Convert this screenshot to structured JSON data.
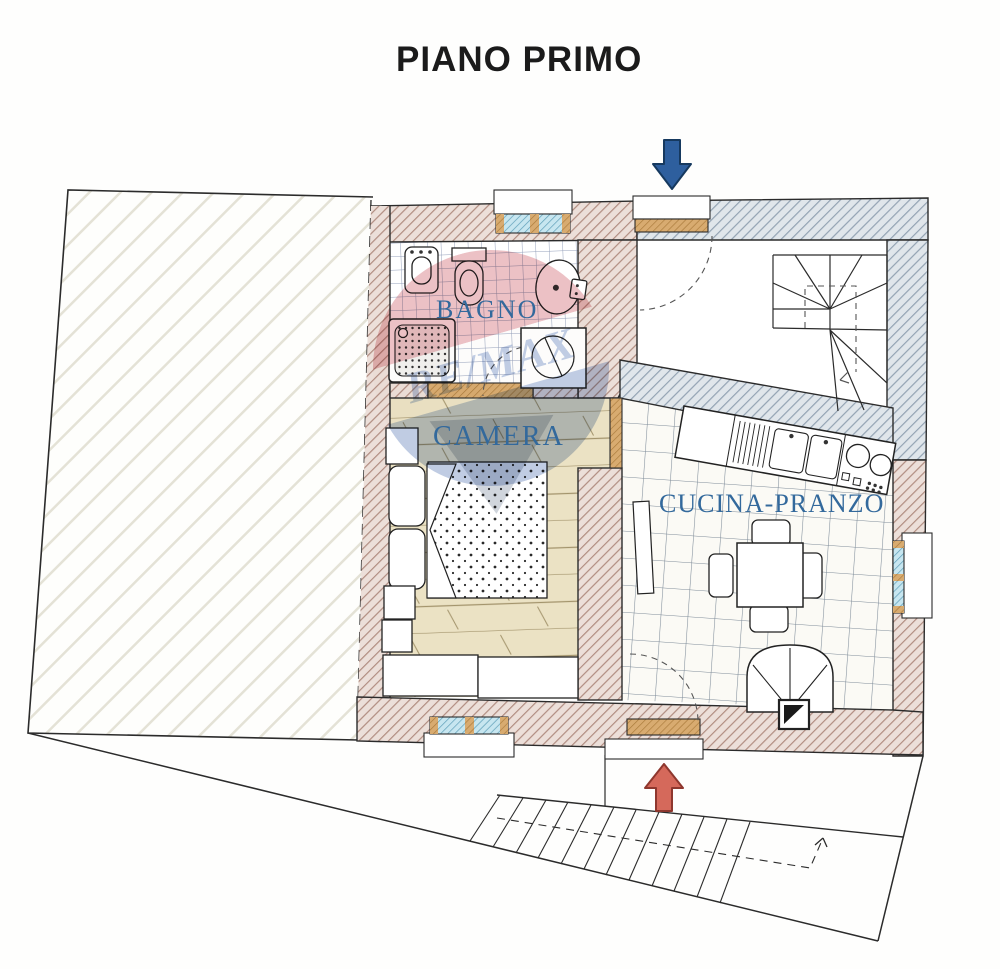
{
  "title": "PIANO PRIMO",
  "rooms": {
    "bathroom": "BAGNO",
    "bedroom": "CAMERA",
    "kitchen_dining": "CUCINA-PRANZO"
  },
  "watermark": {
    "brand": "RE/MAX"
  },
  "arrows": {
    "top": "entrance-arrow-down",
    "bottom": "entrance-arrow-up"
  },
  "colors": {
    "title": "#1b1b1b",
    "label_blue": "#33699c",
    "arrow_down": "#2e5f9e",
    "arrow_up": "#d5695b",
    "wall_brown_line": "#b18d81",
    "wall_gray_line": "#93a3b3",
    "window_blue": "#bfe2ee",
    "threshold_tan": "#d8ab70",
    "wood_floor": "#ebe2c4",
    "watermark_red": "#c5424e",
    "watermark_blue": "#3d63a8"
  }
}
